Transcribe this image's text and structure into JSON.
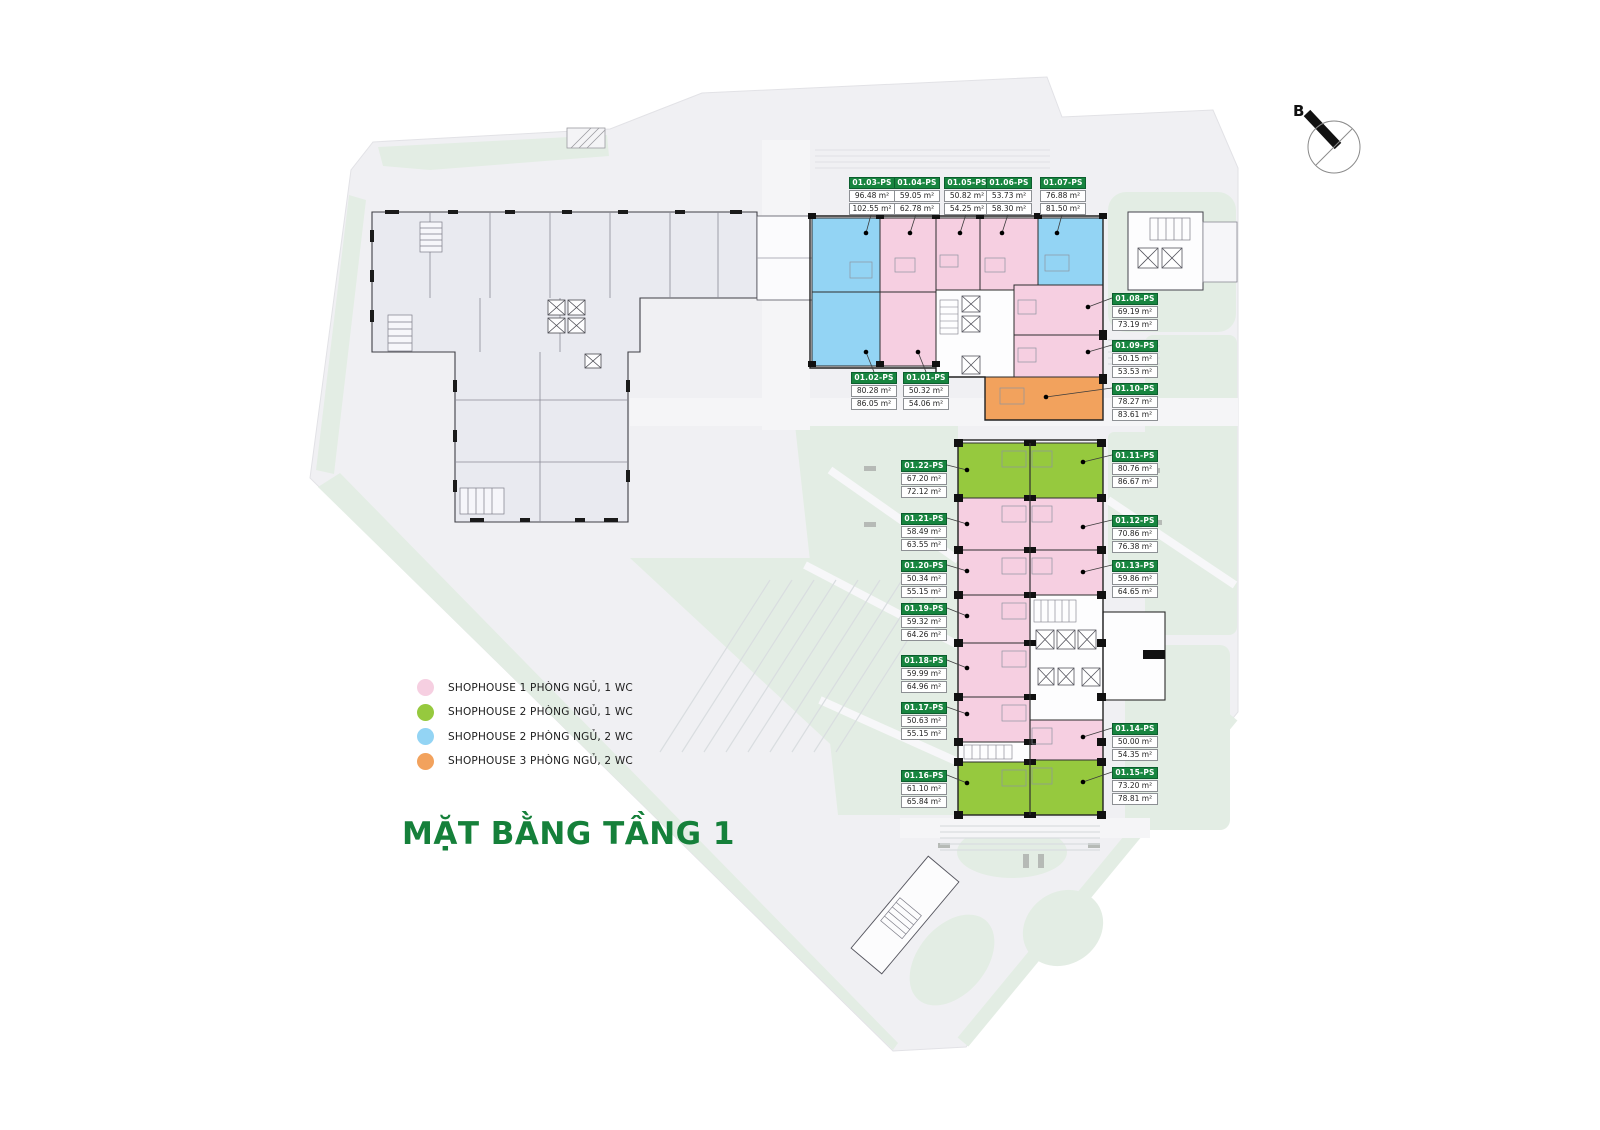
{
  "title": "MẶT BẰNG TẦNG 1",
  "compass": {
    "label": "B"
  },
  "colors": {
    "label_header": "#17853f",
    "title": "#15803a",
    "cat_pink": "#f6cfe1",
    "cat_green": "#96c93e",
    "cat_blue": "#93d4f4",
    "cat_orange": "#f2a25d"
  },
  "legend": [
    {
      "color": "#f6cfe1",
      "label": "SHOPHOUSE 1 PHÒNG NGỦ, 1 WC"
    },
    {
      "color": "#96c93e",
      "label": "SHOPHOUSE 2 PHÒNG NGỦ, 1 WC"
    },
    {
      "color": "#93d4f4",
      "label": "SHOPHOUSE 2 PHÒNG NGỦ, 2 WC"
    },
    {
      "color": "#f2a25d",
      "label": "SHOPHOUSE 3 PHÒNG NGỦ, 2 WC"
    }
  ],
  "units": [
    {
      "id": "01.01-PS",
      "area_net": "50.32 m²",
      "area_gross": "54.06 m²",
      "category": 0
    },
    {
      "id": "01.02-PS",
      "area_net": "80.28 m²",
      "area_gross": "86.05 m²",
      "category": 2
    },
    {
      "id": "01.03-PS",
      "area_net": "96.48 m²",
      "area_gross": "102.55 m²",
      "category": 2
    },
    {
      "id": "01.04-PS",
      "area_net": "59.05 m²",
      "area_gross": "62.78 m²",
      "category": 0
    },
    {
      "id": "01.05-PS",
      "area_net": "50.82 m²",
      "area_gross": "54.25 m²",
      "category": 0
    },
    {
      "id": "01.06-PS",
      "area_net": "53.73 m²",
      "area_gross": "58.30 m²",
      "category": 0
    },
    {
      "id": "01.07-PS",
      "area_net": "76.88 m²",
      "area_gross": "81.50 m²",
      "category": 2
    },
    {
      "id": "01.08-PS",
      "area_net": "69.19 m²",
      "area_gross": "73.19 m²",
      "category": 0
    },
    {
      "id": "01.09-PS",
      "area_net": "50.15 m²",
      "area_gross": "53.53 m²",
      "category": 0
    },
    {
      "id": "01.10-PS",
      "area_net": "78.27 m²",
      "area_gross": "83.61 m²",
      "category": 3
    },
    {
      "id": "01.11-PS",
      "area_net": "80.76 m²",
      "area_gross": "86.67 m²",
      "category": 1
    },
    {
      "id": "01.12-PS",
      "area_net": "70.86 m²",
      "area_gross": "76.38 m²",
      "category": 0
    },
    {
      "id": "01.13-PS",
      "area_net": "59.86 m²",
      "area_gross": "64.65 m²",
      "category": 0
    },
    {
      "id": "01.14-PS",
      "area_net": "50.00 m²",
      "area_gross": "54.35 m²",
      "category": 0
    },
    {
      "id": "01.15-PS",
      "area_net": "73.20 m²",
      "area_gross": "78.81 m²",
      "category": 1
    },
    {
      "id": "01.16-PS",
      "area_net": "61.10 m²",
      "area_gross": "65.84 m²",
      "category": 1
    },
    {
      "id": "01.17-PS",
      "area_net": "50.63 m²",
      "area_gross": "55.15 m²",
      "category": 0
    },
    {
      "id": "01.18-PS",
      "area_net": "59.99 m²",
      "area_gross": "64.96 m²",
      "category": 0
    },
    {
      "id": "01.19-PS",
      "area_net": "59.32 m²",
      "area_gross": "64.26 m²",
      "category": 0
    },
    {
      "id": "01.20-PS",
      "area_net": "50.34 m²",
      "area_gross": "55.15 m²",
      "category": 0
    },
    {
      "id": "01.21-PS",
      "area_net": "58.49 m²",
      "area_gross": "63.55 m²",
      "category": 0
    },
    {
      "id": "01.22-PS",
      "area_net": "67.20 m²",
      "area_gross": "72.12 m²",
      "category": 1
    }
  ]
}
